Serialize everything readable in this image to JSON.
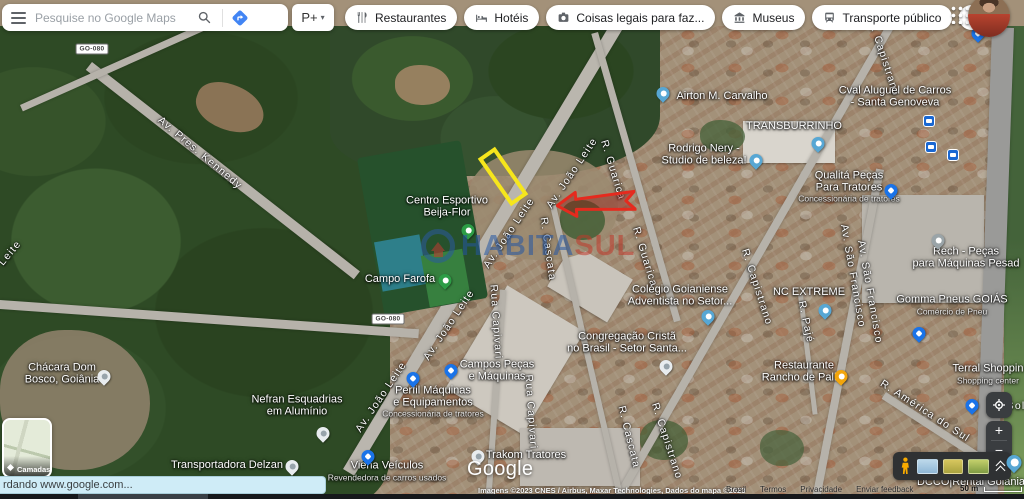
{
  "topbar": {
    "search": {
      "placeholder": "Pesquise no Google Maps"
    },
    "pt_button": {
      "label": "P+",
      "caret": "▾"
    },
    "chips": [
      {
        "label": "Restaurantes",
        "icon": "restaurant-icon"
      },
      {
        "label": "Hotéis",
        "icon": "hotel-icon"
      },
      {
        "label": "Coisas legais para faz...",
        "icon": "camera-icon"
      },
      {
        "label": "Museus",
        "icon": "museum-icon"
      },
      {
        "label": "Transporte público",
        "icon": "transit-icon"
      }
    ]
  },
  "map": {
    "google_logo": "Google",
    "watermark": {
      "text_primary": "HABITA",
      "text_secondary": "SUL"
    },
    "annotation_colors": {
      "highlight_rect": "#f6e61c",
      "arrow": "#e52a1e"
    },
    "road_badges": [
      {
        "text": "GO-080",
        "x": 92,
        "y": 49
      },
      {
        "text": "GO-080",
        "x": 388,
        "y": 319
      }
    ],
    "street_labels": [
      {
        "text": "Av. Pres. Kennedy",
        "x": 200,
        "y": 153,
        "rot": 40
      },
      {
        "text": "Av. João Leite",
        "x": 572,
        "y": 173,
        "rot": -56
      },
      {
        "text": "Av. João Leite",
        "x": 509,
        "y": 233,
        "rot": -56
      },
      {
        "text": "Av. João Leite",
        "x": 449,
        "y": 325,
        "rot": -56
      },
      {
        "text": "Av. João Leite",
        "x": 381,
        "y": 397,
        "rot": -56
      },
      {
        "text": "Leite",
        "x": 10,
        "y": 253,
        "rot": -50
      },
      {
        "text": "R. Guarica",
        "x": 613,
        "y": 170,
        "rot": 73
      },
      {
        "text": "R. Guarica",
        "x": 645,
        "y": 257,
        "rot": 73
      },
      {
        "text": "R. Capistrano",
        "x": 884,
        "y": 58,
        "rot": 72
      },
      {
        "text": "R. Capistrano",
        "x": 757,
        "y": 287,
        "rot": 72
      },
      {
        "text": "R. Capistrano",
        "x": 667,
        "y": 441,
        "rot": 72
      },
      {
        "text": "Av. São Francisco",
        "x": 853,
        "y": 276,
        "rot": 80
      },
      {
        "text": "Av. São Francisco",
        "x": 870,
        "y": 292,
        "rot": 80
      },
      {
        "text": "R. Pajé",
        "x": 806,
        "y": 322,
        "rot": 78
      },
      {
        "text": "Rua Capivari",
        "x": 496,
        "y": 322,
        "rot": 86
      },
      {
        "text": "Rua Capivari",
        "x": 531,
        "y": 412,
        "rot": 86
      },
      {
        "text": "R. Cascata",
        "x": 548,
        "y": 249,
        "rot": 82
      },
      {
        "text": "R. Cascata",
        "x": 629,
        "y": 437,
        "rot": 76
      },
      {
        "text": "R. América do Sul",
        "x": 925,
        "y": 411,
        "rot": 33
      },
      {
        "text": "Sol",
        "x": 1016,
        "y": 406,
        "rot": 0
      }
    ],
    "place_labels": [
      {
        "lines": [
          "Airton M. Carvalho"
        ],
        "x": 722,
        "y": 97,
        "pin": {
          "type": "teal",
          "x": 663,
          "y": 100
        }
      },
      {
        "lines": [
          "TRANSBURRINHO"
        ],
        "x": 794,
        "y": 127,
        "pin": {
          "type": "teal",
          "x": 818,
          "y": 150
        }
      },
      {
        "lines": [
          "Cval Aluguel de Carros",
          "- Santa Genoveva"
        ],
        "x": 895,
        "y": 97,
        "sq_icon": {
          "name": "car-rental-icon",
          "x": 929,
          "y": 121
        }
      },
      {
        "lines": [
          "Rodrigo Nery -",
          "Studio de beleza!"
        ],
        "x": 704,
        "y": 155,
        "pin": {
          "type": "teal",
          "x": 756,
          "y": 167
        }
      },
      {
        "lines": [
          "Qualitá Peças",
          "Para Tratores"
        ],
        "sub": "Concessionária de tratores",
        "x": 849,
        "y": 187,
        "pin": {
          "type": "blue-bag",
          "x": 891,
          "y": 197
        }
      },
      {
        "lines": [
          "Rech - Peças",
          "para Máquinas Pesad"
        ],
        "x": 966,
        "y": 258,
        "pin": {
          "type": "gray",
          "x": 938,
          "y": 247
        }
      },
      {
        "lines": [
          "Gomma Pneus GOIÁS"
        ],
        "sub": "Comércio de Pneu",
        "x": 952,
        "y": 305,
        "pin": {
          "type": "blue-bag",
          "x": 919,
          "y": 340
        }
      },
      {
        "lines": [
          "NC EXTREME"
        ],
        "x": 809,
        "y": 293,
        "pin": {
          "type": "teal",
          "x": 825,
          "y": 317
        }
      },
      {
        "lines": [
          "Colégio Goianiense",
          "Adventista no Setor..."
        ],
        "x": 680,
        "y": 296,
        "pin": {
          "type": "teal",
          "x": 708,
          "y": 323
        }
      },
      {
        "lines": [
          "Congregação Cristã",
          "no Brasil - Setor Santa..."
        ],
        "x": 627,
        "y": 343,
        "pin": {
          "type": "white",
          "x": 666,
          "y": 373
        }
      },
      {
        "lines": [
          "Restaurante",
          "Rancho de Palha"
        ],
        "x": 804,
        "y": 372,
        "pin": {
          "type": "orange",
          "x": 841,
          "y": 383
        }
      },
      {
        "lines": [
          "Campos Peças",
          "e Máquinas"
        ],
        "x": 497,
        "y": 371,
        "pin": {
          "type": "blue-bag",
          "x": 451,
          "y": 377
        }
      },
      {
        "lines": [
          "Perfil Máquinas",
          "e Equipamentos"
        ],
        "sub": "Concessionária de tratores",
        "x": 433,
        "y": 402,
        "pin": {
          "type": "blue-bag",
          "x": 413,
          "y": 385
        }
      },
      {
        "lines": [
          "Viena Veículos"
        ],
        "sub": "Revendedora de carros usados",
        "x": 387,
        "y": 471,
        "pin": {
          "type": "blue-bag",
          "x": 368,
          "y": 463
        }
      },
      {
        "lines": [
          "Trakom Tratores"
        ],
        "x": 526,
        "y": 456,
        "pin": {
          "type": "white",
          "x": 478,
          "y": 463
        }
      },
      {
        "lines": [
          "Chácara Dom",
          "Bosco, Goiânia"
        ],
        "x": 62,
        "y": 374,
        "pin": {
          "type": "white",
          "x": 104,
          "y": 383
        }
      },
      {
        "lines": [
          "Nefran Esquadrias",
          "em Alumínio"
        ],
        "x": 297,
        "y": 406,
        "pin": {
          "type": "white",
          "x": 323,
          "y": 440
        }
      },
      {
        "lines": [
          "Transportadora Delzan"
        ],
        "x": 227,
        "y": 466,
        "pin": {
          "type": "white",
          "x": 292,
          "y": 473
        }
      },
      {
        "lines": [
          "Terral Shoppin"
        ],
        "sub": "Shopping center",
        "x": 988,
        "y": 374,
        "pin": {
          "type": "blue-bag",
          "x": 972,
          "y": 412
        }
      },
      {
        "lines": [
          "Centro Esportivo",
          "Beija-Flor"
        ],
        "x": 447,
        "y": 207,
        "pin": {
          "type": "green",
          "x": 468,
          "y": 237
        }
      },
      {
        "lines": [
          "Campo Farofa"
        ],
        "x": 400,
        "y": 280,
        "pin": {
          "type": "green",
          "x": 445,
          "y": 287
        }
      },
      {
        "lines": [
          "DCCO|Rental Goiânia"
        ],
        "x": 971,
        "y": 483
      }
    ],
    "transit_stops": [
      {
        "x": 931,
        "y": 147
      },
      {
        "x": 953,
        "y": 155
      }
    ],
    "blue_pins": [
      {
        "x": 978,
        "y": 40
      }
    ]
  },
  "controls": {
    "layers_label": "Camadas",
    "zoom_in": "+",
    "zoom_out": "−"
  },
  "statusbar": {
    "text": "rdando www.google.com..."
  },
  "attribution": {
    "imagery": "Imagens ©2023 CNES / Airbus, Maxar Technologies, Dados do mapa ©2023",
    "links": [
      "Brasil",
      "Termos",
      "Privacidade",
      "Enviar feedback"
    ],
    "scale": "50 m"
  }
}
